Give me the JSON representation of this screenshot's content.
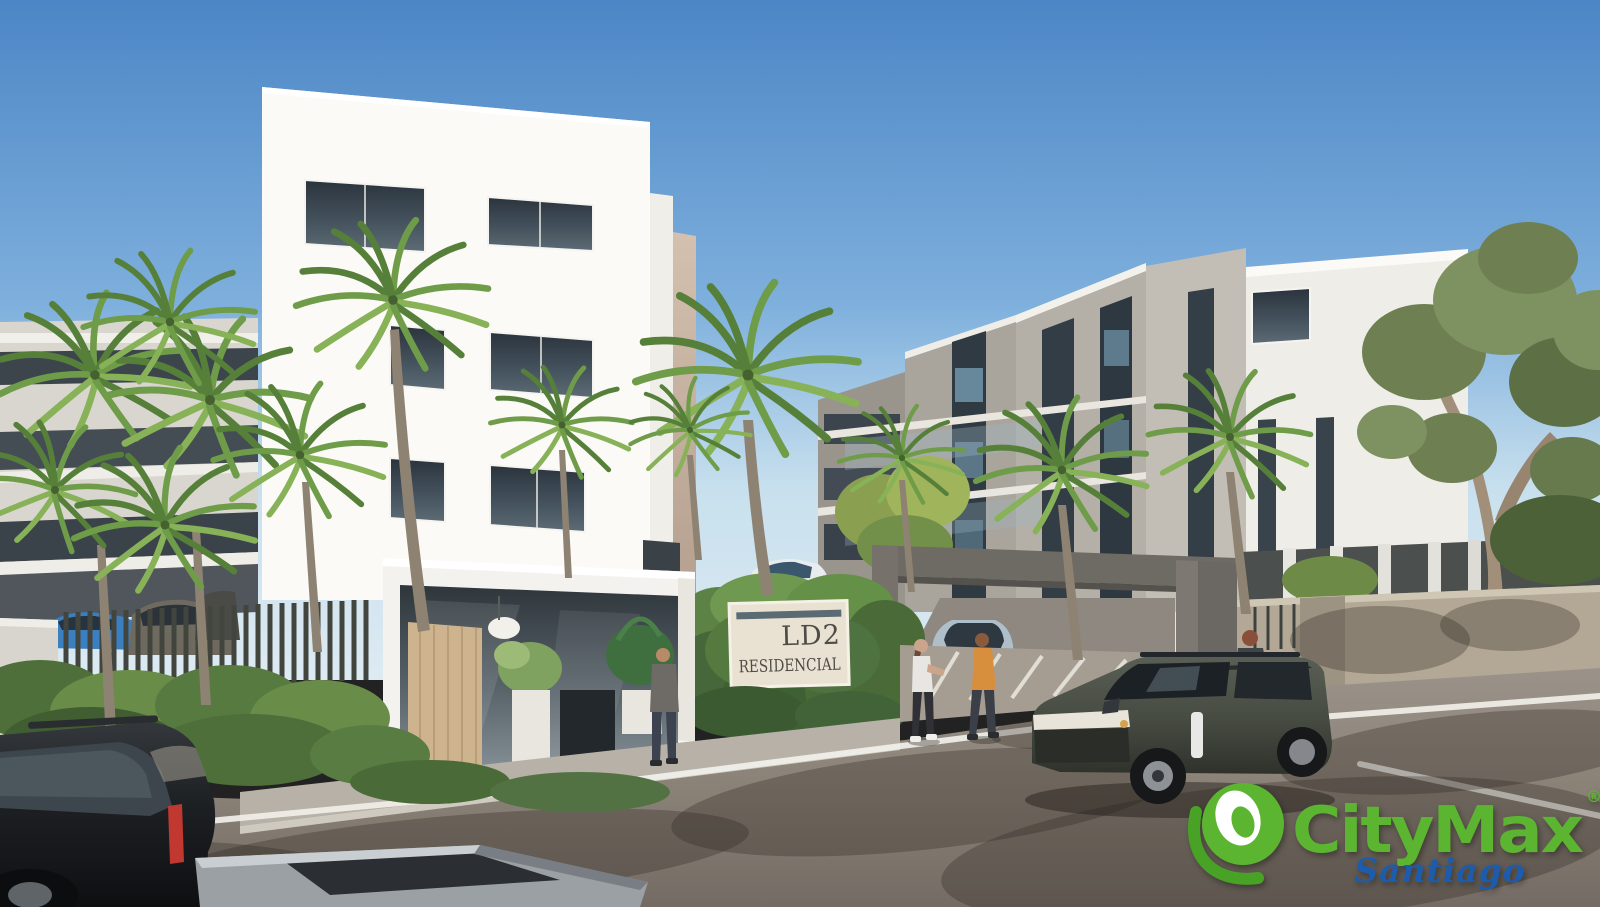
{
  "image": {
    "kind": "architectural-rendering",
    "subject": "Modern white residential apartment complex LD2 Residencial with palm trees, glass entrance lobby, gated driveway, cars, pedestrians and a dark SUV on a sunlit street"
  },
  "sign": {
    "line1": "LD2",
    "line2": "RESIDENCIAL"
  },
  "watermark": {
    "brand": "CityMax",
    "registered": "®",
    "region": "Santiago",
    "brand_color": "#5cb531",
    "region_color": "#1d5cad"
  },
  "palette": {
    "sky_top": "#4c86c6",
    "sky_horizon": "#c8e0ee",
    "building_white": "#f7f5f1",
    "building_tan": "#c9b5a4",
    "building_grey": "#a8a49b",
    "glass_dark": "#2c353e",
    "palm_dark": "#56803a",
    "palm_mid": "#6f9c49",
    "palm_light": "#88b258",
    "hedge_green": "#5d8245",
    "wall_beige": "#b3a896",
    "asphalt": "#8a8177",
    "road_line": "#f1efe9",
    "door_wood": "#cdb48e",
    "suv_dark": "#494e46",
    "black_suv": "#1a1c1e"
  }
}
